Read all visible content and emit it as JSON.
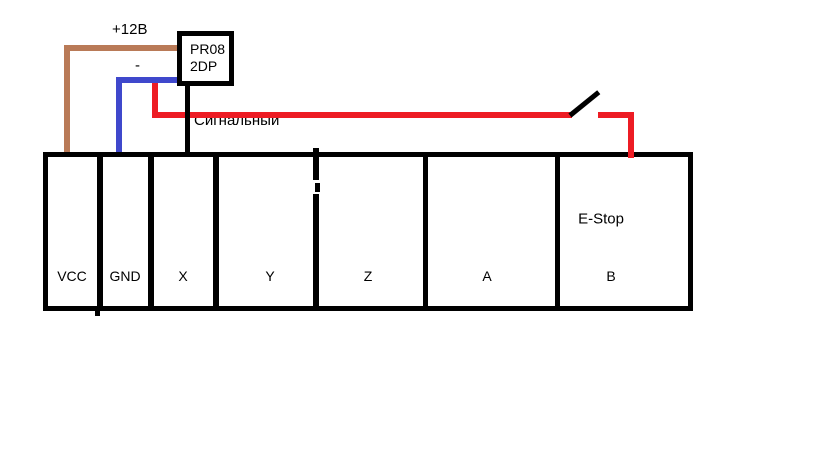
{
  "diagram": {
    "controller": {
      "name_line1": "PR08",
      "name_line2": "2DP"
    },
    "wire_labels": {
      "power": "+12В",
      "ground": "-",
      "signal": "Сигнальный"
    },
    "terminal_strip": {
      "terminals": [
        "VCC",
        "GND",
        "X",
        "Y",
        "Z",
        "A",
        "B"
      ],
      "estop_label": "E-Stop"
    },
    "colors": {
      "power_wire": "#B97A57",
      "ground_wire": "#3F48CC",
      "signal_wire": "#ED1C24",
      "line": "#000000",
      "background": "#FFFFFF"
    }
  }
}
